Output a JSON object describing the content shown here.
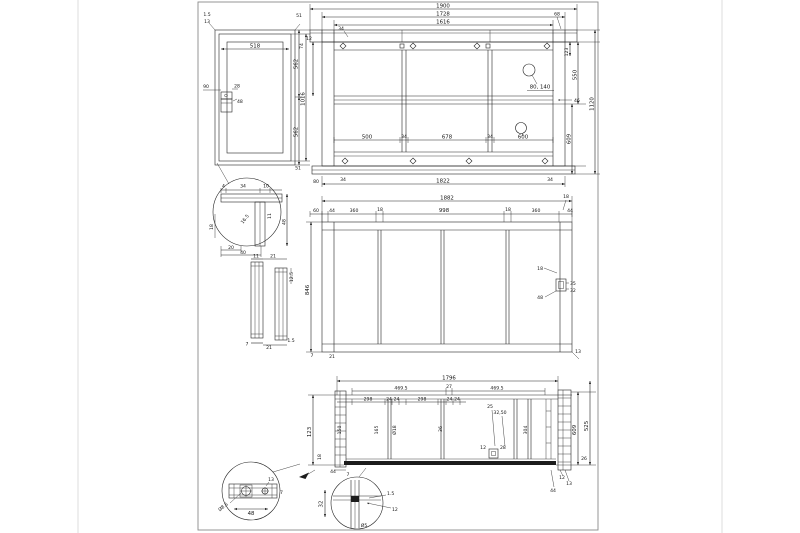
{
  "drawing": {
    "fv": {
      "dim_1900": "1900",
      "dim_1728": "1728",
      "dim_1616": "1616",
      "dim_1822": "1822",
      "dim_34_tl": "34",
      "dim_68": "68",
      "seg_500": "500",
      "seg_34_left": "34",
      "seg_678": "678",
      "seg_34_right": "34",
      "balloon_80_140": "80, 140",
      "balloon_600": "600",
      "dim_12": "12",
      "dim_123": "123",
      "dim_550": "550",
      "dim_609": "609",
      "dim_1120": "1120",
      "dim_46": "46",
      "dim_80": "80",
      "dim_34_bl": "34",
      "dim_34_br": "34"
    },
    "sv": {
      "dim_15": "1.5",
      "dim_13": "13",
      "dim_51_top": "51",
      "dim_74": "74",
      "dim_518": "518",
      "dim_562_top": "562",
      "dim_1016": "1016",
      "dim_562_bot": "562",
      "dim_90": "90",
      "dim_28": "28",
      "dim_48": "48",
      "dim_51_bot": "51"
    },
    "da": {
      "dim_4": "4",
      "dim_34": "34",
      "dim_10": "10",
      "dim_48": "48",
      "dim_11": "11",
      "dim_165": "16.5",
      "dim_20": "20",
      "dim_40": "40",
      "dim_18": "18"
    },
    "pr": {
      "dim_11": "11",
      "dim_21_top": "21",
      "dim_125": "12.5",
      "dim_7": "7",
      "dim_21_bot": "21",
      "dim_15": "1.5"
    },
    "mv": {
      "dim_1882": "1882",
      "seg_60": "60",
      "seg_44_l": "44",
      "seg_360_l": "360",
      "seg_18_l": "18",
      "seg_998": "998",
      "seg_18_r": "18",
      "seg_360_r": "360",
      "seg_18_tr": "18",
      "seg_44_r": "44",
      "dim_846": "846",
      "dim_18": "18",
      "dim_48": "48",
      "dim_35": "35",
      "dim_32": "32",
      "dim_7": "7",
      "dim_21": "21",
      "dim_13": "13"
    },
    "bv": {
      "dim_1796": "1796",
      "dim_4695_l": "469.5",
      "dim_27": "27",
      "dim_4695_r": "469.5",
      "seg_298_l": "298",
      "seg_24_a": "24",
      "seg_24_b": "24",
      "seg_298_r": "298",
      "seg_24_c": "24",
      "seg_24_d": "24",
      "dim_25": "25",
      "dim_3250": "32,50",
      "dim_123": "123",
      "dim_150": "150",
      "dim_165": "165",
      "dim_o18": "Ø18",
      "dim_36": "36",
      "dim_304": "304",
      "dim_609": "609",
      "dim_525": "525",
      "dim_26": "26",
      "dim_12_br": "12",
      "dim_13_br": "13",
      "dim_44_br": "44",
      "dim_44_l": "44",
      "dim_7": "7",
      "dim_18": "18",
      "dim_12_sq": "12",
      "dim_28_sq": "28"
    },
    "db": {
      "dim_13": "13",
      "dim_7": "7",
      "dim_48": "48",
      "dim_dia": "Ø8.5"
    },
    "dc": {
      "dim_32": "32",
      "dim_15": "1.5",
      "dim_12": "12",
      "dim_o5": "Ø5"
    }
  }
}
